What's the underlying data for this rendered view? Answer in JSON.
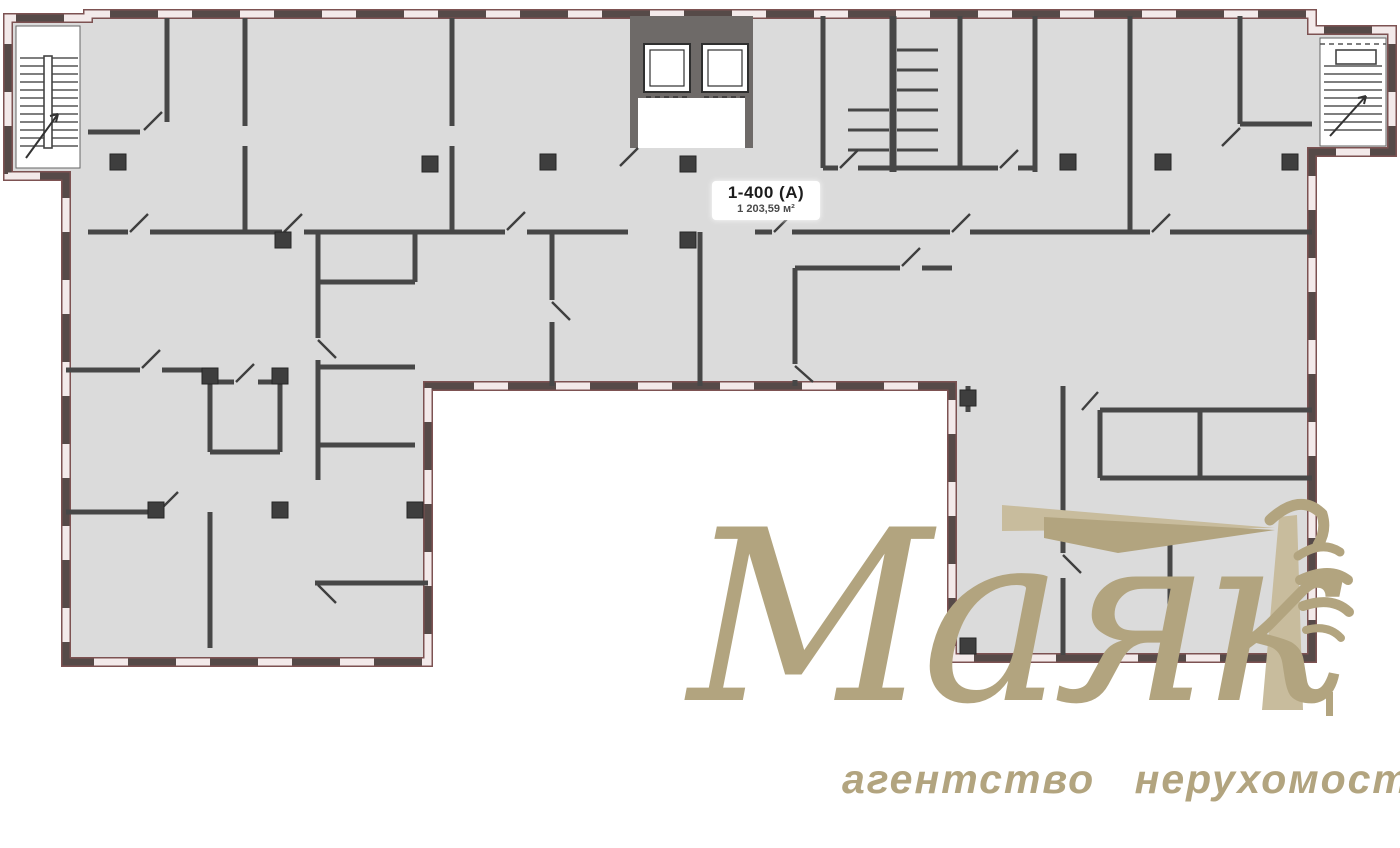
{
  "plan": {
    "unit_label": "1-400 (А)",
    "unit_area": "1 203,59 м²"
  },
  "watermark": {
    "brand_name": "Маяк",
    "tagline": "агентство нерухомості"
  },
  "colors": {
    "floor": "#dbdbdb",
    "exterior_wall": "#564a48",
    "window_glass": "#f3eaea",
    "window_frame": "#7d5252",
    "interior_wall": "#474747",
    "column": "#3e3e3e",
    "core_wall": "#6e6a68",
    "stair_line": "#555555",
    "watermark_gold": "#b2a47f",
    "watermark_gold_light": "#c8bc9d",
    "label_text": "#1c1c1c"
  }
}
